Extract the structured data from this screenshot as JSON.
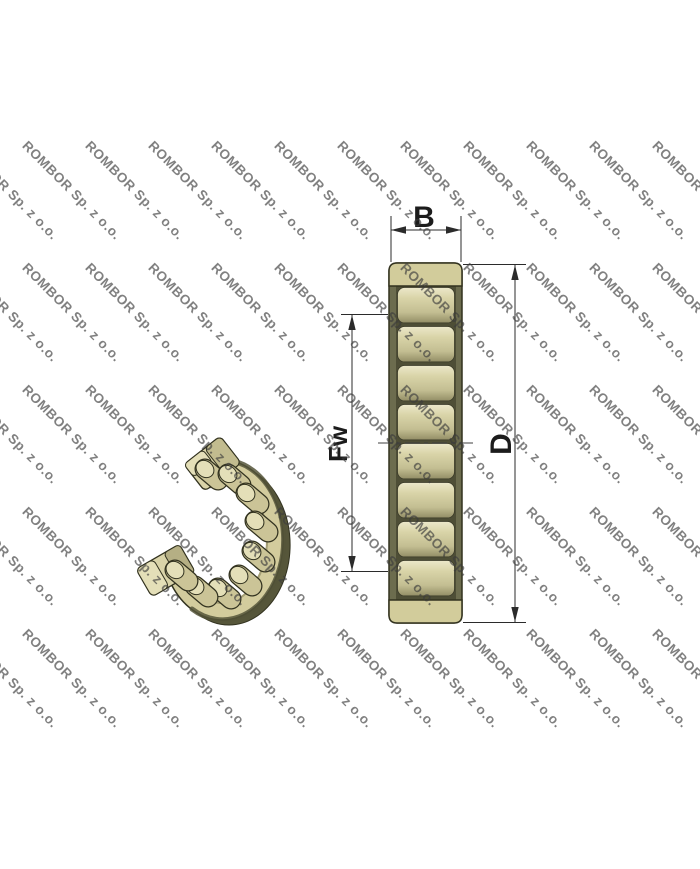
{
  "watermark": {
    "text": "ROMBOR Sp. z o.o.",
    "color": "rgba(60,60,60,0.65)",
    "rotation_deg": 45,
    "grid": {
      "col_start_x": -33,
      "col_step_x": 63,
      "cols": 12,
      "row_start_y": 138,
      "row_step_y": 122,
      "rows": 5
    }
  },
  "drawing": {
    "labels": {
      "section_width": "B",
      "bore_diameter": "Fw",
      "outer_diameter": "D"
    },
    "colors": {
      "outline": "#32321f",
      "dim_line": "#2b2b2b",
      "label_text": "#1c1c1c",
      "body_tan": "#d2cc9b",
      "hatch_line": "#8a8560",
      "olive_mid": "#6c6c4e",
      "olive_dark": "#4e4e36",
      "roller_light": "#ece8ca",
      "roller_mid": "#d9d4a8",
      "roller_deep": "#c3be92",
      "roller_dark": "#938e66",
      "ring_tan": "#d3cc9d",
      "ring_shadow": "#56563a",
      "end_face_light": "#e4dfb8",
      "background": "#ffffff"
    }
  }
}
